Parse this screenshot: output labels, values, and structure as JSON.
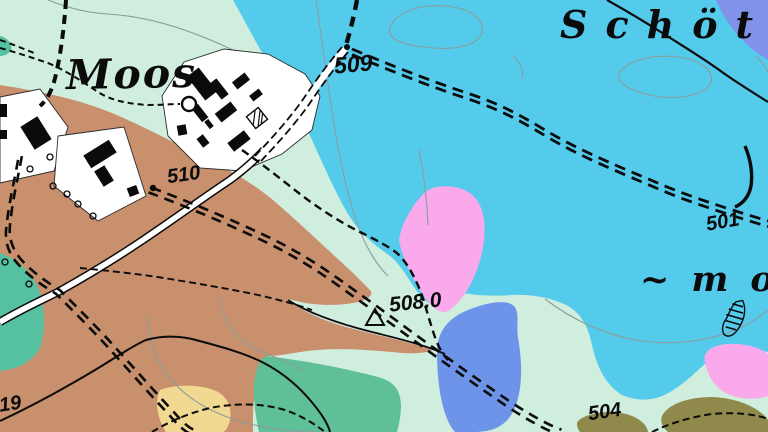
{
  "map": {
    "labels": {
      "village": "Moos",
      "region_line1": "Schötm",
      "region_line2": "~mo"
    },
    "spot_heights": {
      "h509": "509",
      "h510": "510",
      "h508": "508.0",
      "h501": "501",
      "h504": "504",
      "h519": "519"
    },
    "symbols": [
      "trig-point-triangle",
      "marsh-symbol",
      "tree-circles",
      "round-tank",
      "hatched-building"
    ],
    "colors": {
      "mint": "#cfeede",
      "cyan": "#55cbec",
      "brown": "#c9906e",
      "teal": "#55c1a1",
      "green": "#5fbf97",
      "pink": "#f9a9ec",
      "blue": "#6e94e9",
      "bluecorner": "#8092e9",
      "olive": "#8f8a4b",
      "yellow": "#f2d992",
      "contour": "#8a9d9d",
      "ink": "#0b0b0b",
      "road": "#ffffff"
    }
  }
}
